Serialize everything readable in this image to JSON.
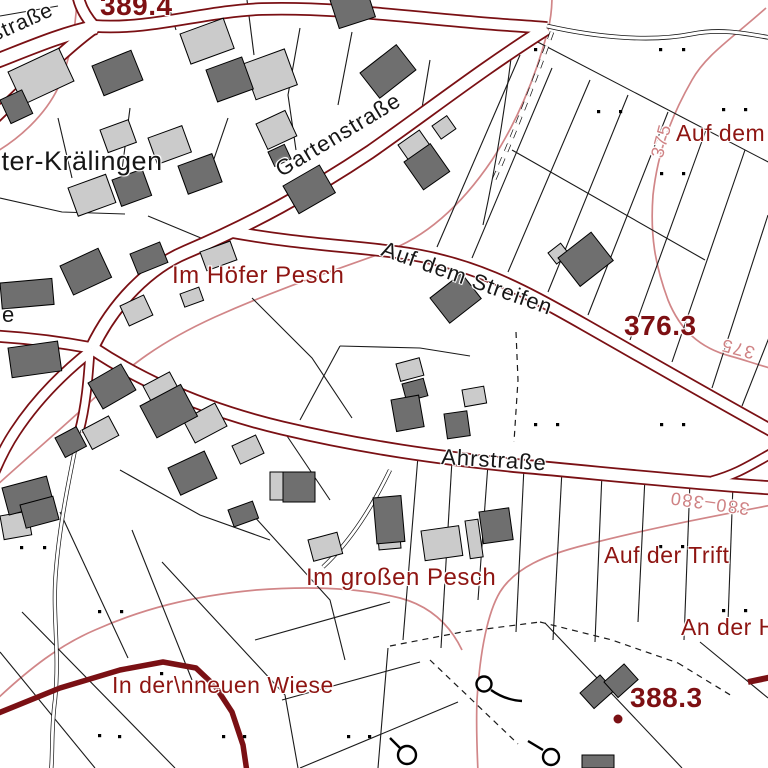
{
  "map": {
    "colors": {
      "road_casing": "#7a1014",
      "label_red": "#8e1512",
      "spot_red": "#7d1013",
      "contour_pink": "#d18688",
      "building_dark": "#6f6f6f",
      "building_light": "#cbcbcb",
      "parcel_line": "#1a1a1a"
    },
    "place_labels": [
      {
        "text": "nter-Krälingen"
      }
    ],
    "street_labels": [
      {
        "text": "straße"
      },
      {
        "text": "Gartenstraße"
      },
      {
        "text": "Auf dem Streifen"
      },
      {
        "text": "Ahrstraße"
      },
      {
        "text": "e"
      }
    ],
    "area_labels": [
      {
        "text": "Im Höfer Pesch"
      },
      {
        "text": "Auf dem"
      },
      {
        "text": "Auf der Trift"
      },
      {
        "text": "An der H"
      },
      {
        "text": "Im großen Pesch"
      },
      {
        "text": "In der\\nneuen Wiese"
      }
    ],
    "spot_elevations": [
      {
        "value": "389.4"
      },
      {
        "value": "376.3"
      },
      {
        "value": "388.3"
      }
    ],
    "contour_labels": [
      {
        "value": "375"
      },
      {
        "value": "375"
      },
      {
        "value": "380–380"
      }
    ]
  }
}
